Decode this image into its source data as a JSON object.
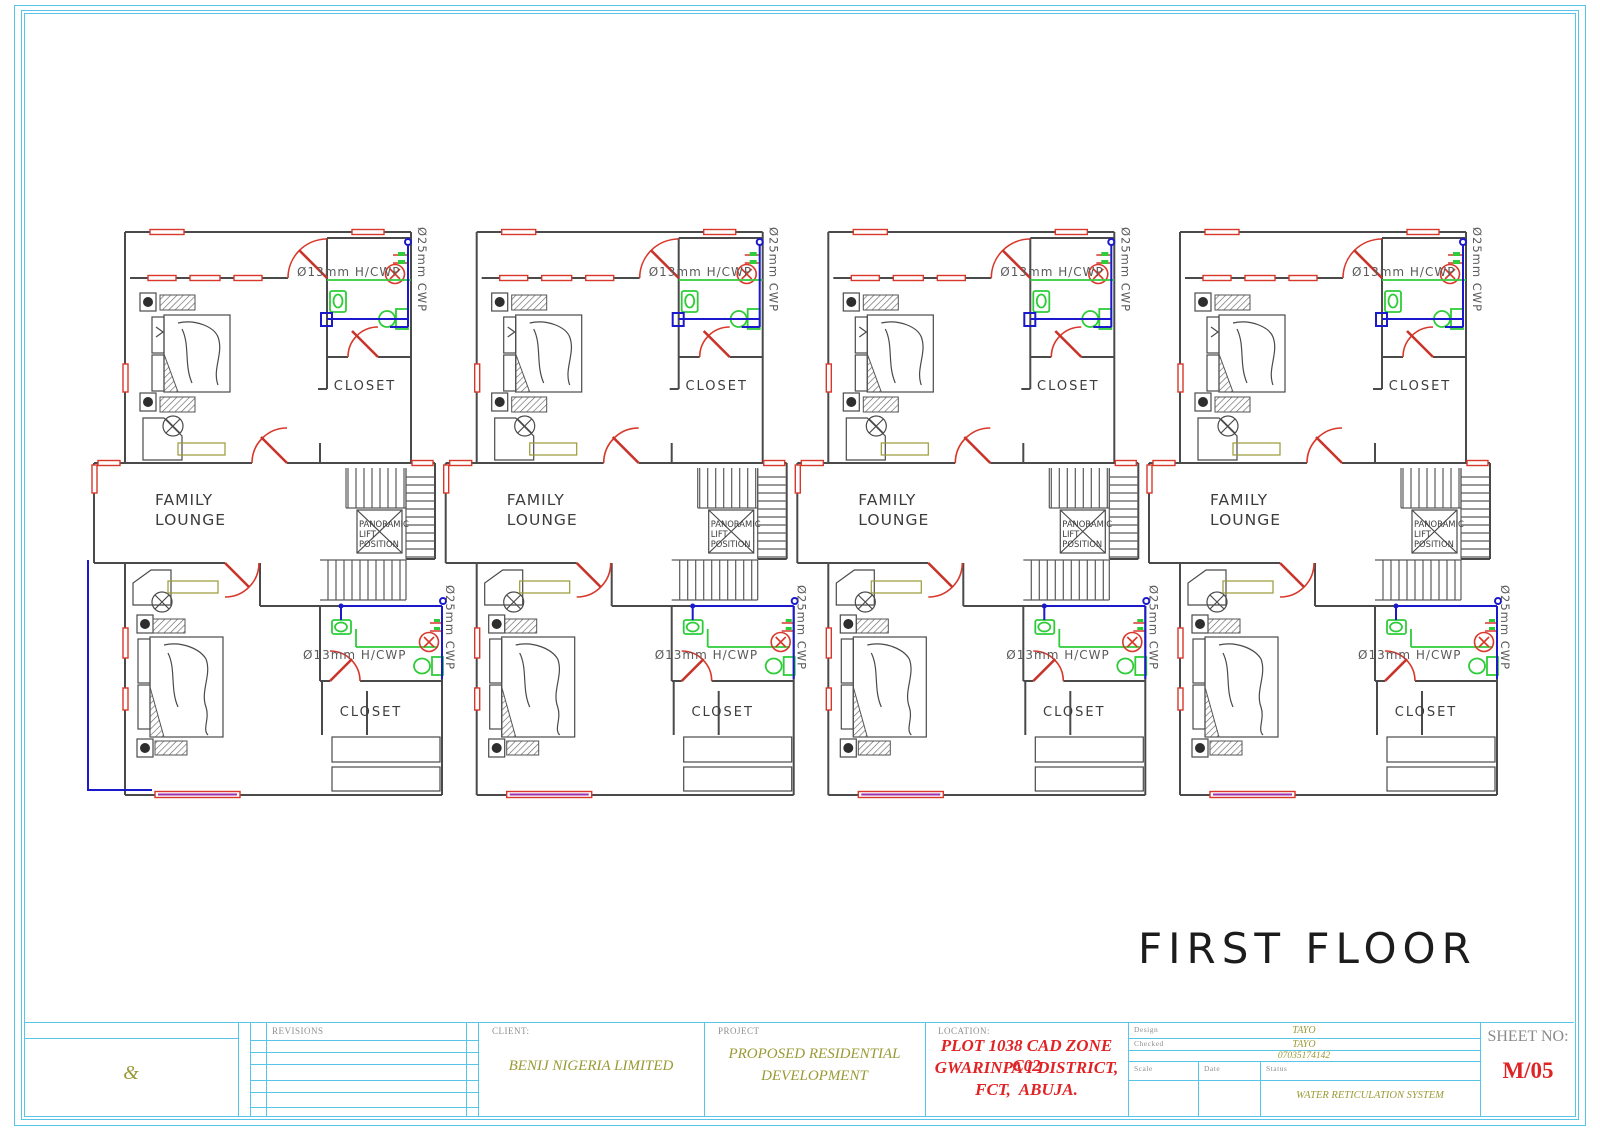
{
  "sheet": {
    "floor_title": "FIRST FLOOR"
  },
  "plan": {
    "unit_count": 4,
    "labels": {
      "family_lounge_line1": "FAMILY",
      "family_lounge_line2": "LOUNGE",
      "closet": "CLOSET",
      "lift_line1": "PANORAMIC",
      "lift_line2": "LIFT",
      "lift_line3": "POSITION",
      "pipe_13mm": "Ø13mm H/CWP",
      "pipe_25mm": "Ø25mm CWP"
    },
    "colors": {
      "wall": "#4a4a4a",
      "doors_windows": "#d8372a",
      "cold_water_pipe": "#1a1acc",
      "fixtures": "#2fcc3a",
      "furniture": "#9a9a35",
      "supply_line": "#9b30b0",
      "frame": "#57c5e8"
    }
  },
  "title_block": {
    "ampersand": "&",
    "revisions_label": "REVISIONS",
    "client_label": "CLIENT:",
    "client_name": "BENIJ NIGERIA LIMITED",
    "project_label": "PROJECT",
    "project_line1": "PROPOSED RESIDENTIAL",
    "project_line2": "DEVELOPMENT",
    "location_label": "LOCATION:",
    "location_line1": "PLOT 1038 CAD ZONE C02",
    "location_line2": "GWARINPA I DISTRICT,",
    "location_line3": "FCT,  ABUJA.",
    "design_label": "Design",
    "design_value": "TAYO",
    "checked_label": "Checked",
    "checked_value": "TAYO",
    "phone": "07035174142",
    "scale_label": "Scale",
    "date_label": "Date",
    "status_label": "Status",
    "status_value": "WATER RETICULATION SYSTEM",
    "sheet_no_label": "SHEET NO:",
    "sheet_no_value": "M/05"
  }
}
